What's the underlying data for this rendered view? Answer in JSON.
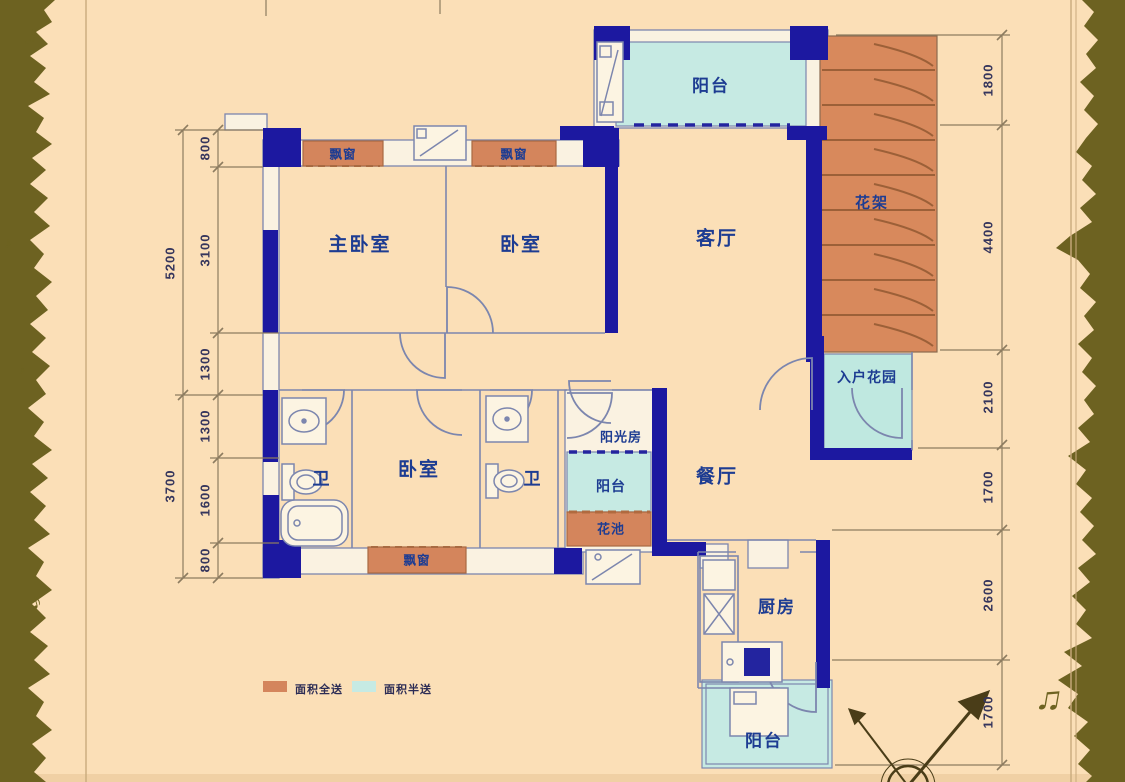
{
  "rooms": {
    "balcony_top": "阳台",
    "flower_rack": "花架",
    "master_bedroom": "主卧室",
    "bedroom_top": "卧室",
    "living_room": "客厅",
    "bay_window_top_left": "飘窗",
    "bay_window_top_right": "飘窗",
    "bay_window_bottom": "飘窗",
    "bath_left": "卫",
    "bedroom_lower": "卧室",
    "bath_right": "卫",
    "sunroom": "阳光房",
    "balcony_mid": "阳台",
    "flower_bed": "花池",
    "dining_room": "餐厅",
    "entry_garden": "入户花园",
    "kitchen": "厨房",
    "balcony_bottom": "阳台"
  },
  "dimensions": {
    "left_outer": [
      "5200",
      "3700"
    ],
    "left_inner": [
      "800",
      "3100",
      "1300",
      "1300",
      "1600",
      "800"
    ],
    "right": [
      "1800",
      "4400",
      "2100",
      "1700",
      "2600",
      "1700"
    ]
  },
  "legend": {
    "full_area": "面积全送",
    "half_area": "面积半送"
  },
  "icons": {
    "note_single": "♪",
    "note_beamed": "♫"
  },
  "colors": {
    "background": "#fbdfb7",
    "wall_navy": "#1c18a0",
    "area_full_orange": "#d4855c",
    "area_half_cyan": "#c6eae3",
    "border_olive": "#6d6221",
    "label_text": "#1d3c92"
  }
}
